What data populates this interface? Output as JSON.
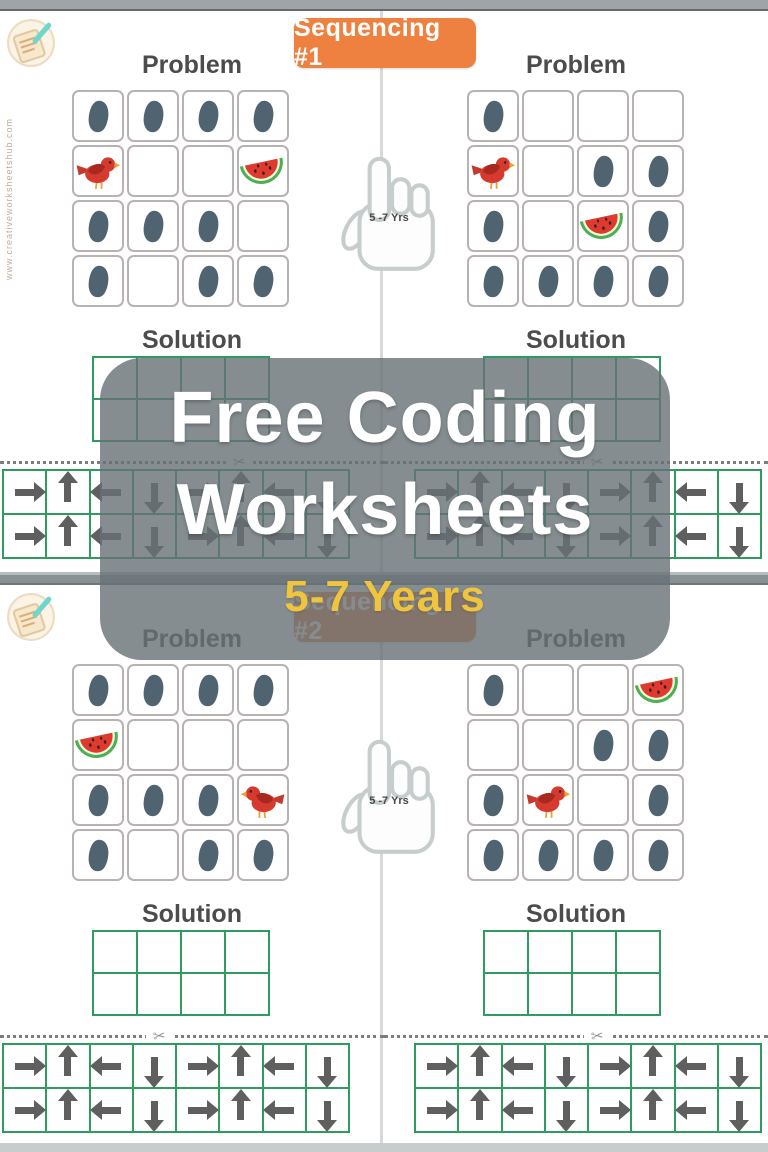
{
  "overlay": {
    "title_line1": "Free Coding",
    "title_line2": "Worksheets",
    "subtitle": "5-7 Years"
  },
  "labels": {
    "problem": "Problem",
    "solution": "Solution",
    "age_badge": "5 -7 Yrs",
    "watermark": "www.creativeworksheetshub.com",
    "scissors_icon": "✂"
  },
  "colors": {
    "badge_orange": "#ee8040",
    "grid_green": "#2f9c5f",
    "subtitle_yellow": "#f0c43c",
    "arrow_gray": "#5f5f5f",
    "footprint_slate": "#4f6370",
    "bird_red": "#d63a2f"
  },
  "pages": [
    {
      "badge": "Sequencing #1",
      "halves": [
        {
          "problem": [
            [
              "footprint",
              "footprint",
              "footprint",
              "footprint"
            ],
            [
              "bird-right",
              "",
              "",
              "watermelon"
            ],
            [
              "footprint",
              "footprint",
              "footprint",
              ""
            ],
            [
              "footprint",
              "",
              "footprint",
              "footprint"
            ]
          ],
          "solution": {
            "rows": 2,
            "cols": 4
          },
          "arrows": [
            [
              "right",
              "up",
              "left",
              "down",
              "right",
              "up",
              "left",
              "down"
            ],
            [
              "right",
              "up",
              "left",
              "down",
              "right",
              "up",
              "left",
              "down"
            ]
          ]
        },
        {
          "problem": [
            [
              "footprint",
              "",
              "",
              ""
            ],
            [
              "bird-right",
              "",
              "footprint",
              "footprint"
            ],
            [
              "footprint",
              "",
              "watermelon",
              "footprint"
            ],
            [
              "footprint",
              "footprint",
              "footprint",
              "footprint"
            ]
          ],
          "solution": {
            "rows": 2,
            "cols": 4
          },
          "arrows": [
            [
              "right",
              "up",
              "left",
              "down",
              "right",
              "up",
              "left",
              "down"
            ],
            [
              "right",
              "up",
              "left",
              "down",
              "right",
              "up",
              "left",
              "down"
            ]
          ]
        }
      ]
    },
    {
      "badge": "Sequencing #2",
      "halves": [
        {
          "problem": [
            [
              "footprint",
              "footprint",
              "footprint",
              "footprint"
            ],
            [
              "watermelon",
              "",
              "",
              ""
            ],
            [
              "footprint",
              "footprint",
              "footprint",
              "bird-left"
            ],
            [
              "footprint",
              "",
              "footprint",
              "footprint"
            ]
          ],
          "solution": {
            "rows": 2,
            "cols": 4
          },
          "arrows": [
            [
              "right",
              "up",
              "left",
              "down",
              "right",
              "up",
              "left",
              "down"
            ],
            [
              "right",
              "up",
              "left",
              "down",
              "right",
              "up",
              "left",
              "down"
            ]
          ]
        },
        {
          "problem": [
            [
              "footprint",
              "",
              "",
              "watermelon"
            ],
            [
              "",
              "",
              "footprint",
              "footprint"
            ],
            [
              "footprint",
              "bird-right",
              "",
              "footprint"
            ],
            [
              "footprint",
              "footprint",
              "footprint",
              "footprint"
            ]
          ],
          "solution": {
            "rows": 2,
            "cols": 4
          },
          "arrows": [
            [
              "right",
              "up",
              "left",
              "down",
              "right",
              "up",
              "left",
              "down"
            ],
            [
              "right",
              "up",
              "left",
              "down",
              "right",
              "up",
              "left",
              "down"
            ]
          ]
        }
      ]
    }
  ]
}
